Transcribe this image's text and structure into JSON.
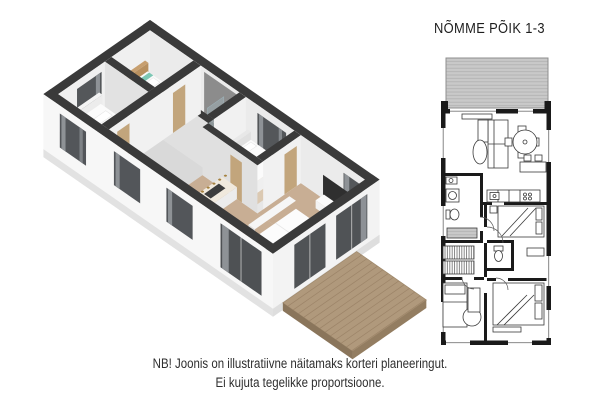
{
  "title": "NÕMME PÕIK 1-3",
  "disclaimer": {
    "line1": "NB! Joonis on illustratiivne näitamaks korteri planeeringut.",
    "line2": "Ei kujuta tegelikke proportsioone."
  },
  "colors": {
    "background": "#ffffff",
    "wall_top_dark": "#3a3a3a",
    "wall_exterior_white": "#f7f7f7",
    "wall_interior_light": "#f1f1f1",
    "wall_interior_shaded": "#e0e0e0",
    "wood_floor": "#c8ae94",
    "bedroom_floor": "#dbc9b2",
    "hall_floor": "#d9d9d9",
    "bathroom_floor": "#7d7d7d",
    "deck_wood": "#b0997c",
    "deck_plank_line": "#9d8569",
    "window_glass": "#53565a",
    "curtain_gray": "#8e9296",
    "door_wood": "#c2a57c",
    "accent_teal": "#7cc7b4",
    "bed_white": "#fbfbfb",
    "plan_wall_black": "#1a1a1a",
    "terrace_fill": "#c9c9c9",
    "terrace_hatch": "#b0b0b0"
  }
}
